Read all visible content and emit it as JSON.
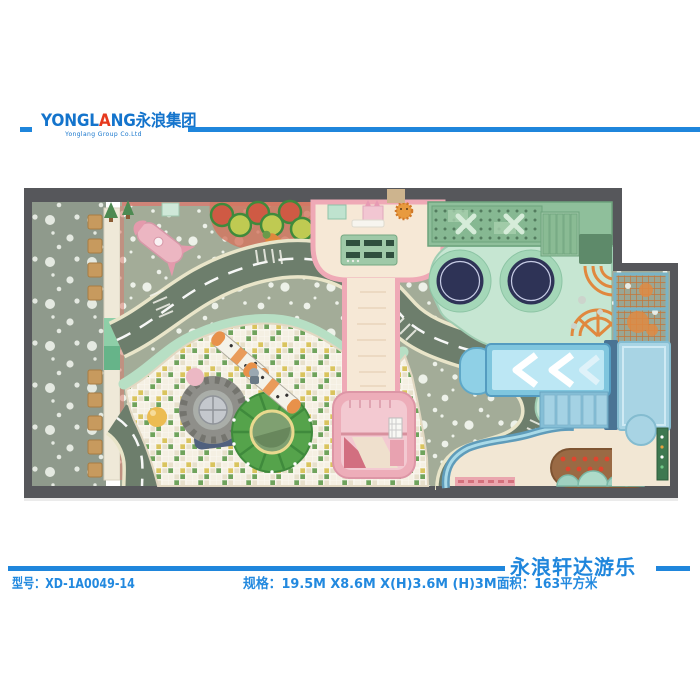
{
  "header": {
    "logo_main_pre": "YONGL",
    "logo_accent": "A",
    "logo_main_post": "NG",
    "logo_cjk": "永浪集团",
    "logo_sub": "Yonglang Group Co.Ltd",
    "brand_blue": "#1474cc",
    "accent_red": "#e6391e",
    "rule_blue": "#1f86dc"
  },
  "footer": {
    "brand": "永浪轩达游乐",
    "model": "型号：XD-1A0049-14",
    "spec": "规格：19.5M X8.6M X(H)3.6M (H)3M",
    "area": "面积：163平方米",
    "text_color": "#2289df"
  },
  "floorplan": {
    "wall_color": "#56575b",
    "entrance_floor_color": "#8f9a8c",
    "mat_color": "#a3ac98",
    "road_color": "#6d7e6c",
    "road_edge_color": "#e9e5c9",
    "ballpit_mosaic_colors": [
      "#f5f0e3",
      "#6fa35c",
      "#d9c45e"
    ],
    "pink_wall_color": "#efa9b6",
    "pink_floor_color": "#f6e8d6",
    "trampoline_platform_color": "#c6e6d2",
    "trampoline_color": "#2e3356",
    "climber_green_color": "#8fbf9b",
    "slide_blue_color": "#8fd0e6",
    "net_orange_color": "#e08a42",
    "sand_color": "#f2e7d4",
    "garden_brown_color": "#9a6a44",
    "features": [
      "entrance-lounge",
      "bench-stools",
      "race-track",
      "ball-pit",
      "tire-toy",
      "carousel",
      "zebra-rollers",
      "toddler-area",
      "interactive-table",
      "pink-walkway",
      "pink-slide-tower",
      "trampolines",
      "climbing-structure",
      "stairs",
      "rope-climb",
      "net-climb",
      "blue-slide",
      "sand-area",
      "vegetable-garden",
      "mushroom-seats",
      "rocket-toy",
      "tree-toys",
      "carrot-toy"
    ]
  }
}
